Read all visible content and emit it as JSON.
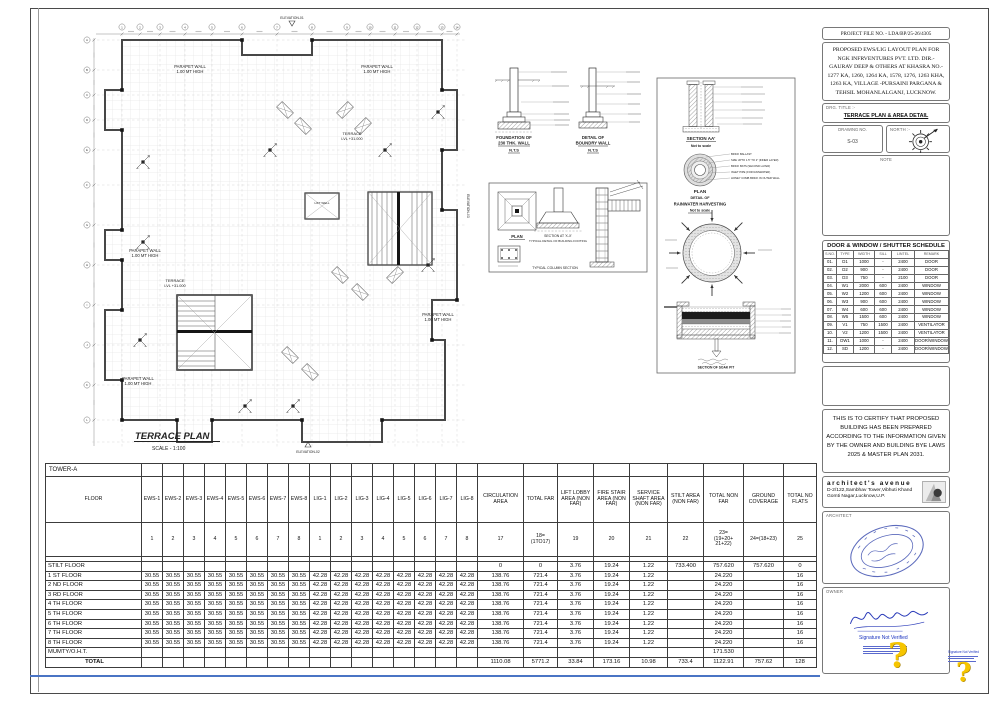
{
  "sheet": {
    "plan": {
      "title": "TERRACE PLAN",
      "scale": "SCALE - 1:100",
      "labels": {
        "parapet_l1": "PARAPET WALL",
        "parapet_l2": "1.00 MT HIGH",
        "terrace_l1": "TERRACE",
        "terrace_l2": "LVL +31.000",
        "lift_well": "LIFT WELL",
        "elev_top": "ELEVATION-01",
        "elev_bottom": "ELEVATION-02",
        "elev_right": "ELEVATION-03"
      }
    },
    "details": {
      "foundation": [
        "FOUNDATION OF",
        "230 THK. WALL",
        "N.T.S"
      ],
      "boundary": [
        "DETAIL OF",
        "BOUNDRY WALL",
        "N.T.S"
      ],
      "typical": {
        "plan": "PLAN",
        "section": "SECTION AT 'X-X'",
        "footing": "TYPICAL DETAIL OF BUILDING FOOTING",
        "column": "TYPICAL COLUMN SECTION"
      }
    },
    "rainwater": {
      "section_title": "SECTION AA'",
      "nts": "Not to scale",
      "plan": "PLAN",
      "detail_of": "DETAIL OF",
      "rwh": "RAINWATER HARVESTING",
      "soak": "SECTION OF SOAK PIT",
      "labels": [
        "BRICK BALLAST",
        "SIZE UPTO 1.5\" TO 2\" (INNER LAYER)",
        "BRICK BATS (SECOND LAYER)",
        "INLET PIPE (FOR RAINWATER)",
        "HONEY COMB BRICK IN OUTER WALL"
      ]
    }
  },
  "titleblock": {
    "project_file_no": "PROJECT FILE NO. - LDA/BP/25-26/4305",
    "description": "PROPOSED EWS/LIG LAYOUT PLAN FOR NGK INFRVENTURES PVT. LTD. DIR.- GAURAV DEEP & OTHERS AT KHASRA NO.- 1277 KA, 1260, 1264 KA, 1578, 1276, 1263 KHA, 1263 KA, VILLAGE -PURSAINI PARGANA & TEHSIL MOHANLALGANJ, LUCKNOW.",
    "drg_title_label": "DRG. TITLE :-",
    "drg_title": "TERRACE PLAN & AREA DETAIL",
    "drawing_no_label": "DRAWING NO.",
    "drawing_no": "S-03",
    "north_label": "NORTH :-",
    "note_label": "NOTE",
    "certification": "THIS IS TO CERTIFY THAT PROPOSED BUILDING HAS BEEN PREPARED ACCORDING TO THE INFORMATION GIVEN BY THE OWNER AND BUILDING BYE LAWS 2025 & MASTER PLAN 2031.",
    "firm_name": "architect's avenue",
    "firm_address": "D-2/122,Sambhav Tower,Vibhuti Khand Gomti Nagar,Lucknow,U.P.",
    "architect_label": "ARCHITECT",
    "owner_label": "OWNER",
    "signature_not_verified": "Signature Not Verified"
  },
  "schedule": {
    "title": "DOOR & WINDOW / SHUTTER SCHEDULE",
    "columns": [
      "S.NO.",
      "TYPE",
      "WIDTH",
      "SILL",
      "LINTEL",
      "REMARK"
    ],
    "rows": [
      [
        "01.",
        "D1",
        "1000",
        "-",
        "2400",
        "DOOR"
      ],
      [
        "02.",
        "D2",
        "900",
        "-",
        "2400",
        "DOOR"
      ],
      [
        "03.",
        "D3",
        "750",
        "-",
        "2100",
        "DOOR"
      ],
      [
        "04.",
        "W1",
        "2000",
        "600",
        "2400",
        "WINDOW"
      ],
      [
        "05.",
        "W2",
        "1200",
        "600",
        "2400",
        "WINDOW"
      ],
      [
        "06.",
        "W3",
        "900",
        "600",
        "2400",
        "WINDOW"
      ],
      [
        "07.",
        "W4",
        "600",
        "600",
        "2400",
        "WINDOW"
      ],
      [
        "08.",
        "W5",
        "1500",
        "600",
        "2400",
        "WINDOW"
      ],
      [
        "09.",
        "V1",
        "750",
        "1500",
        "2400",
        "VENTILATOR"
      ],
      [
        "10.",
        "V2",
        "1200",
        "1500",
        "2400",
        "VENTILATOR"
      ],
      [
        "11.",
        "DW1",
        "1000",
        "-",
        "2400",
        "DOOR/WINDOW"
      ],
      [
        "12.",
        "SD",
        "1200",
        "-",
        "2400",
        "DOOR/WINDOW"
      ]
    ]
  },
  "area_table": {
    "tower": "TOWER-A",
    "floor_col": "FLOOR",
    "unit_columns": [
      "EWS-1",
      "EWS-2",
      "EWS-3",
      "EWS-4",
      "EWS-5",
      "EWS-6",
      "EWS-7",
      "EWS-8",
      "LIG-1",
      "LIG-2",
      "LIG-3",
      "LIG-4",
      "LIG-5",
      "LIG-6",
      "LIG-7",
      "LIG-8"
    ],
    "unit_numbers": [
      "1",
      "2",
      "3",
      "4",
      "5",
      "6",
      "7",
      "8",
      "1",
      "2",
      "3",
      "4",
      "5",
      "6",
      "7",
      "8"
    ],
    "area_columns": [
      {
        "label": "CIRCULATION AREA",
        "num": "17"
      },
      {
        "label": "TOTAL FAR",
        "num": "18=\n(1TO17)"
      },
      {
        "label": "LIFT LOBBY AREA (NON FAR)",
        "num": "19"
      },
      {
        "label": "FIRE STAIR AREA (NON FAR)",
        "num": "20"
      },
      {
        "label": "SERVICE SHAFT AREA (NON FAR)",
        "num": "21"
      },
      {
        "label": "STILT AREA (NON FAR)",
        "num": "22"
      },
      {
        "label": "TOTAL NON FAR",
        "num": "23=\n(19+20+\n21+22)"
      },
      {
        "label": "GROUND COVERAGE",
        "num": "24=(18+23)"
      },
      {
        "label": "TOTAL NO FLATS",
        "num": "25"
      }
    ],
    "rows": [
      {
        "floor": "STILT FLOOR",
        "units": [
          "",
          "",
          "",
          "",
          "",
          "",
          "",
          "",
          "",
          "",
          "",
          "",
          "",
          "",
          "",
          ""
        ],
        "areas": [
          "0",
          "0",
          "3.76",
          "19.24",
          "1.22",
          "733.400",
          "757.620",
          "757.620",
          "0"
        ]
      },
      {
        "floor": "1 ST FLOOR",
        "units": [
          "30.55",
          "30.55",
          "30.55",
          "30.55",
          "30.55",
          "30.55",
          "30.55",
          "30.55",
          "42.28",
          "42.28",
          "42.28",
          "42.28",
          "42.28",
          "42.28",
          "42.28",
          "42.28"
        ],
        "areas": [
          "138.76",
          "721.4",
          "3.76",
          "19.24",
          "1.22",
          "",
          "24.220",
          "",
          "16"
        ]
      },
      {
        "floor": "2 ND FLOOR",
        "units": [
          "30.55",
          "30.55",
          "30.55",
          "30.55",
          "30.55",
          "30.55",
          "30.55",
          "30.55",
          "42.28",
          "42.28",
          "42.28",
          "42.28",
          "42.28",
          "42.28",
          "42.28",
          "42.28"
        ],
        "areas": [
          "138.76",
          "721.4",
          "3.76",
          "19.24",
          "1.22",
          "",
          "24.220",
          "",
          "16"
        ]
      },
      {
        "floor": "3 RD FLOOR",
        "units": [
          "30.55",
          "30.55",
          "30.55",
          "30.55",
          "30.55",
          "30.55",
          "30.55",
          "30.55",
          "42.28",
          "42.28",
          "42.28",
          "42.28",
          "42.28",
          "42.28",
          "42.28",
          "42.28"
        ],
        "areas": [
          "138.76",
          "721.4",
          "3.76",
          "19.24",
          "1.22",
          "",
          "24.220",
          "",
          "16"
        ]
      },
      {
        "floor": "4 TH FLOOR",
        "units": [
          "30.55",
          "30.55",
          "30.55",
          "30.55",
          "30.55",
          "30.55",
          "30.55",
          "30.55",
          "42.28",
          "42.28",
          "42.28",
          "42.28",
          "42.28",
          "42.28",
          "42.28",
          "42.28"
        ],
        "areas": [
          "138.76",
          "721.4",
          "3.76",
          "19.24",
          "1.22",
          "",
          "24.220",
          "",
          "16"
        ]
      },
      {
        "floor": "5 TH FLOOR",
        "units": [
          "30.55",
          "30.55",
          "30.55",
          "30.55",
          "30.55",
          "30.55",
          "30.55",
          "30.55",
          "42.28",
          "42.28",
          "42.28",
          "42.28",
          "42.28",
          "42.28",
          "42.28",
          "42.28"
        ],
        "areas": [
          "138.76",
          "721.4",
          "3.76",
          "19.24",
          "1.22",
          "",
          "24.220",
          "",
          "16"
        ]
      },
      {
        "floor": "6 TH FLOOR",
        "units": [
          "30.55",
          "30.55",
          "30.55",
          "30.55",
          "30.55",
          "30.55",
          "30.55",
          "30.55",
          "42.28",
          "42.28",
          "42.28",
          "42.28",
          "42.28",
          "42.28",
          "42.28",
          "42.28"
        ],
        "areas": [
          "138.76",
          "721.4",
          "3.76",
          "19.24",
          "1.22",
          "",
          "24.220",
          "",
          "16"
        ]
      },
      {
        "floor": "7 TH FLOOR",
        "units": [
          "30.55",
          "30.55",
          "30.55",
          "30.55",
          "30.55",
          "30.55",
          "30.55",
          "30.55",
          "42.28",
          "42.28",
          "42.28",
          "42.28",
          "42.28",
          "42.28",
          "42.28",
          "42.28"
        ],
        "areas": [
          "138.76",
          "721.4",
          "3.76",
          "19.24",
          "1.22",
          "",
          "24.220",
          "",
          "16"
        ]
      },
      {
        "floor": "8 TH FLOOR",
        "units": [
          "30.55",
          "30.55",
          "30.55",
          "30.55",
          "30.55",
          "30.55",
          "30.55",
          "30.55",
          "42.28",
          "42.28",
          "42.28",
          "42.28",
          "42.28",
          "42.28",
          "42.28",
          "42.28"
        ],
        "areas": [
          "138.76",
          "721.4",
          "3.76",
          "19.24",
          "1.22",
          "",
          "24.220",
          "",
          "16"
        ]
      },
      {
        "floor": "MUMTY/O.H.T.",
        "units": [
          "",
          "",
          "",
          "",
          "",
          "",
          "",
          "",
          "",
          "",
          "",
          "",
          "",
          "",
          "",
          ""
        ],
        "areas": [
          "",
          "",
          "",
          "",
          "",
          "",
          "171.530",
          "",
          ""
        ]
      },
      {
        "floor": "TOTAL",
        "units": [
          "",
          "",
          "",
          "",
          "",
          "",
          "",
          "",
          "",
          "",
          "",
          "",
          "",
          "",
          "",
          ""
        ],
        "areas": [
          "1110.08",
          "5771.2",
          "33.84",
          "173.16",
          "10.98",
          "733.4",
          "1122.91",
          "757.62",
          "128"
        ]
      }
    ]
  }
}
